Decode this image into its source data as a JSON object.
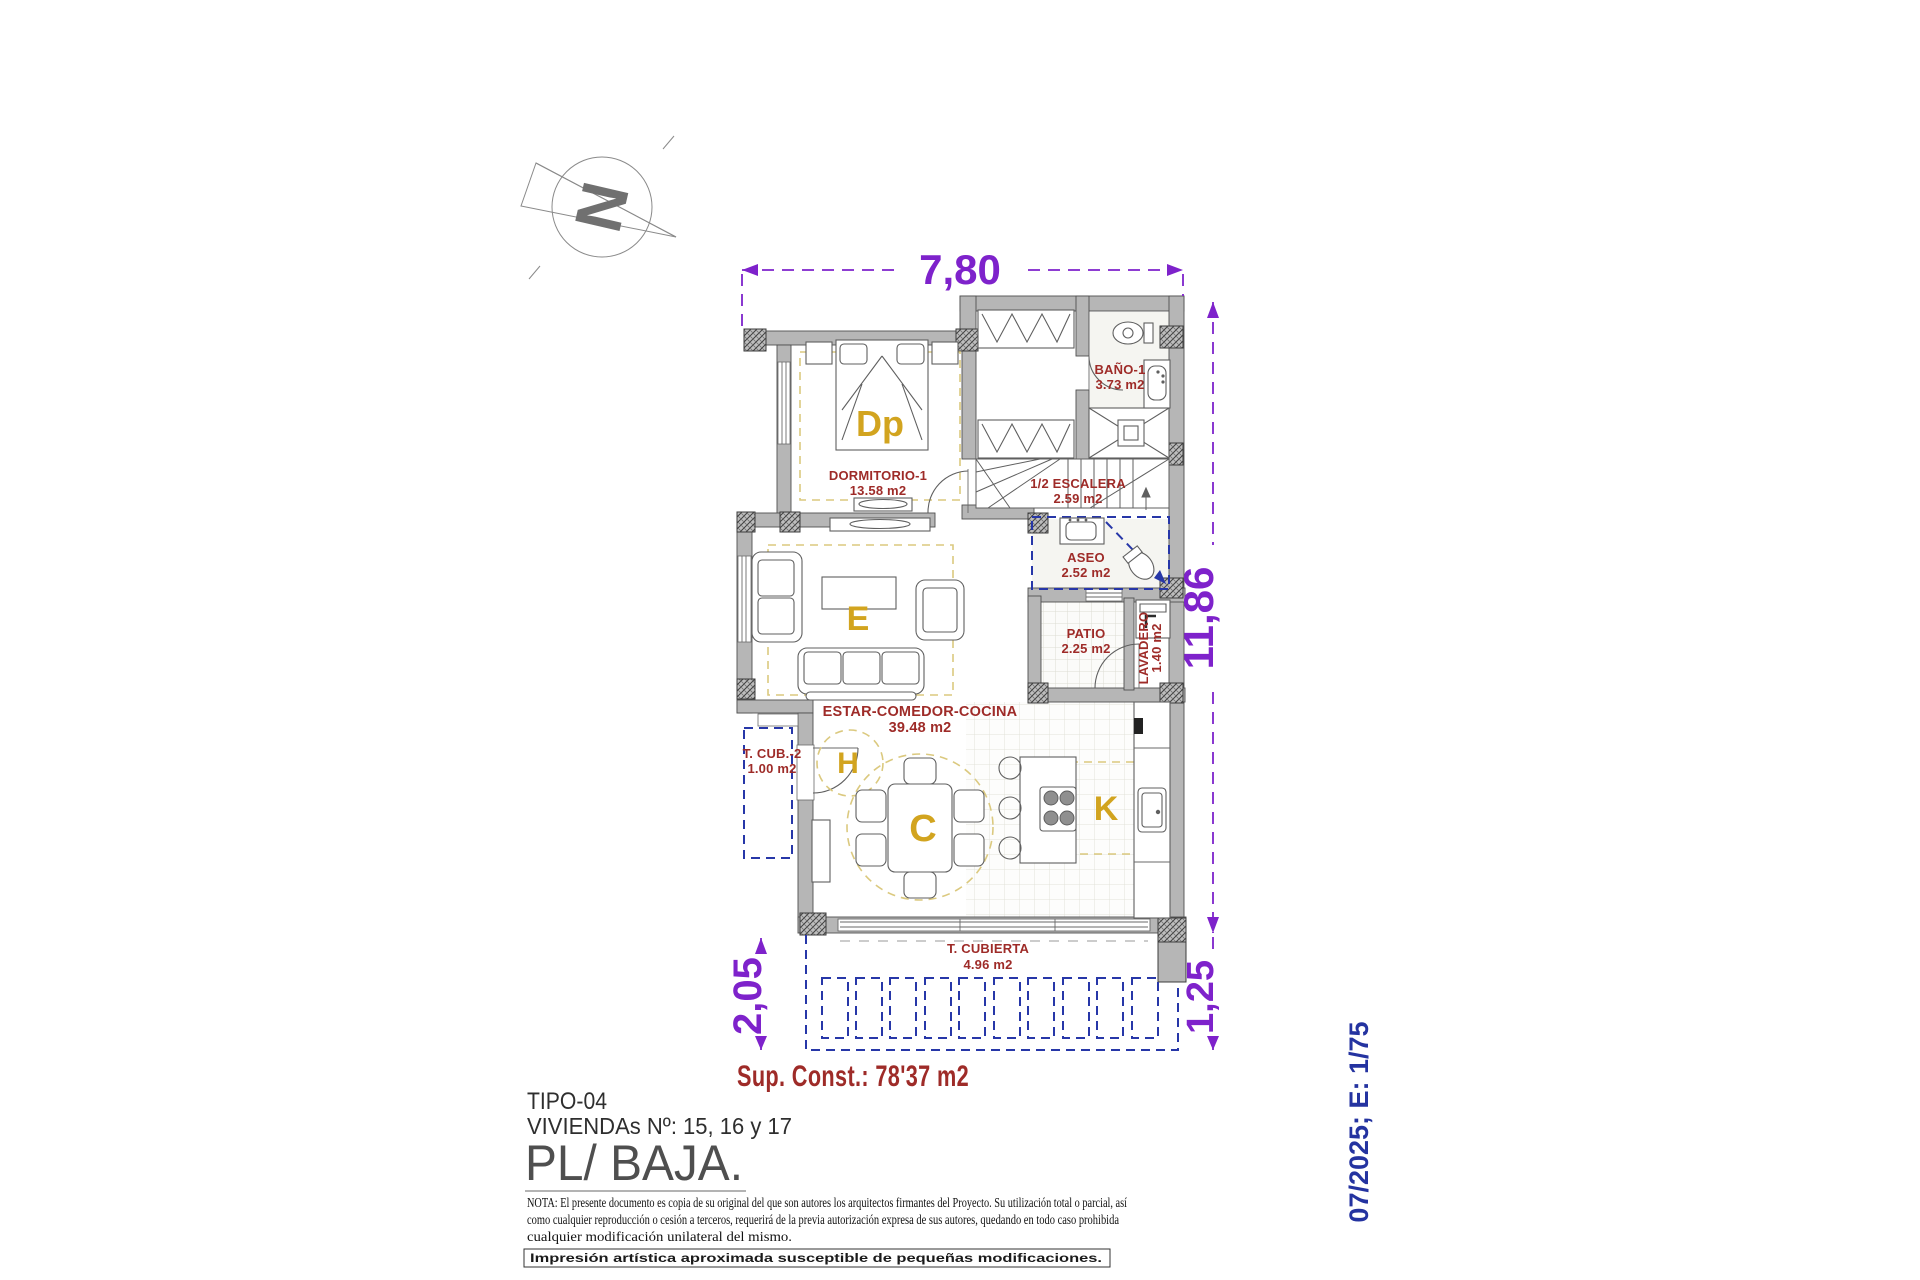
{
  "colors": {
    "wall_gray": "#b6b6b6",
    "label_red": "#9e2b28",
    "zone_gold": "#d2a41f",
    "dim_purple": "#7e22cb",
    "plan_blue": "#2737a8",
    "dash_yellow": "#dbc97f"
  },
  "compass": {
    "north_letter": "N"
  },
  "dimensions": {
    "top_width": "7,80",
    "right_height": "11,86",
    "bottom_left_height": "2,05",
    "bottom_right_height": "1,25"
  },
  "rooms": {
    "dormitorio": {
      "name": "DORMITORIO-1",
      "area": "13.58 m2",
      "code": "Dp"
    },
    "banyo": {
      "name": "BAÑO-1",
      "area": "3.73 m2"
    },
    "escalera": {
      "name": "1/2 ESCALERA",
      "area": "2.59 m2"
    },
    "aseo": {
      "name": "ASEO",
      "area": "2.52 m2"
    },
    "patio": {
      "name": "PATIO",
      "area": "2.25 m2"
    },
    "lavadero": {
      "name": "LAVADERO",
      "area": "1.40 m2"
    },
    "estar": {
      "name": "ESTAR-COMEDOR-COCINA",
      "area": "39.48 m2",
      "living_code": "E",
      "hall_code": "H",
      "dining_code": "C",
      "kitchen_code": "K"
    },
    "terraza_cubierta_2": {
      "name": "T. CUB.-2",
      "area": "1.00 m2"
    },
    "terraza_cubierta": {
      "name": "T. CUBIERTA",
      "area": "4.96 m2"
    }
  },
  "summary": {
    "built_area": "Sup. Const.: 78'37 m2"
  },
  "title_block": {
    "type": "TIPO-04",
    "homes": "VIVIENDAs Nº: 15, 16 y 17",
    "floor": "PL/ BAJA.",
    "note_line1": "NOTA: El presente documento es copia de su original del que son autores los arquitectos firmantes del Proyecto. Su utilización total o parcial, así",
    "note_line2": "como cualquier reproducción o cesión a terceros, requerirá  de la previa autorización expresa de sus autores, quedando en todo caso prohibida",
    "note_line3": "cualquier modificación unilateral del mismo.",
    "disclaimer": "Impresión  artística  aproximada  susceptible  de  pequeñas  modificaciones."
  },
  "stamp": {
    "date_scale": "07/2025; E: 1/75"
  }
}
